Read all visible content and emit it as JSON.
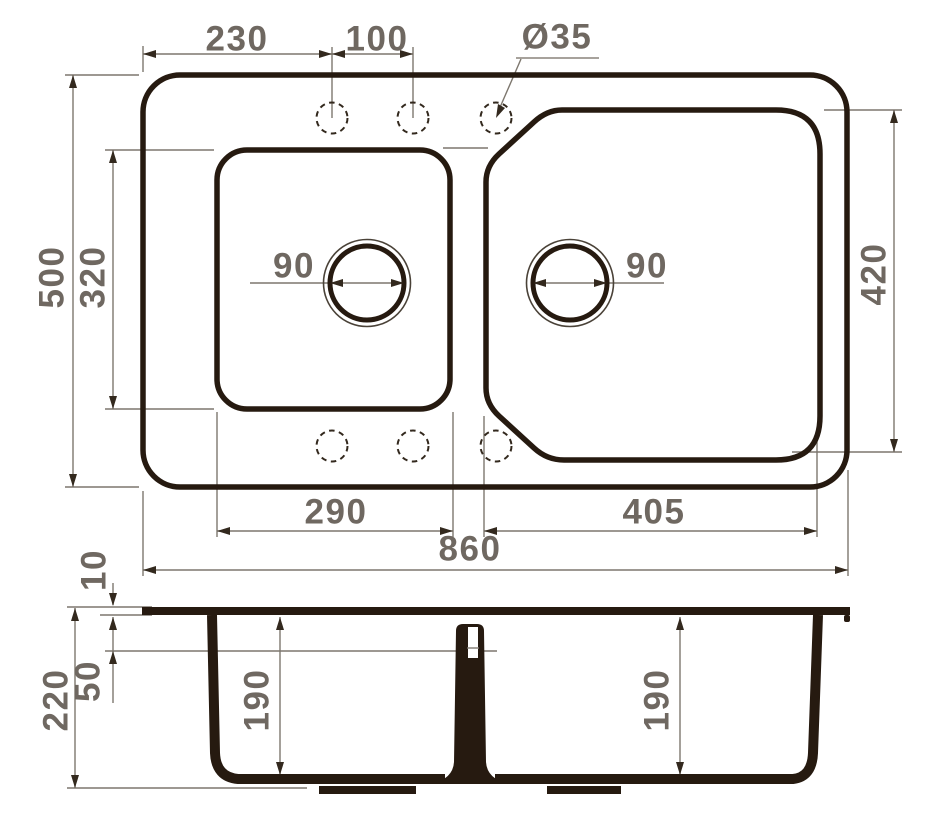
{
  "drawing": {
    "type": "sink-technical-drawing",
    "background": "#ffffff",
    "colors": {
      "outline": "#261a10",
      "dimension_text": "#6f6861",
      "dimension_line": "#7d776e",
      "arrow": "#33291e"
    },
    "top_view": {
      "faucet_hole_offset": "230",
      "faucet_hole_spacing": "100",
      "faucet_hole_diameter": "Ø35",
      "overall_depth": "500",
      "left_bowl_length": "320",
      "left_drain_diameter": "90",
      "right_drain_diameter": "90",
      "right_bowl_length": "420",
      "left_bowl_width": "290",
      "right_bowl_width": "405",
      "overall_width": "860"
    },
    "section_view": {
      "rim_thickness": "10",
      "overflow_level": "50",
      "overall_height": "220",
      "left_bowl_depth": "190",
      "right_bowl_depth": "190"
    }
  }
}
